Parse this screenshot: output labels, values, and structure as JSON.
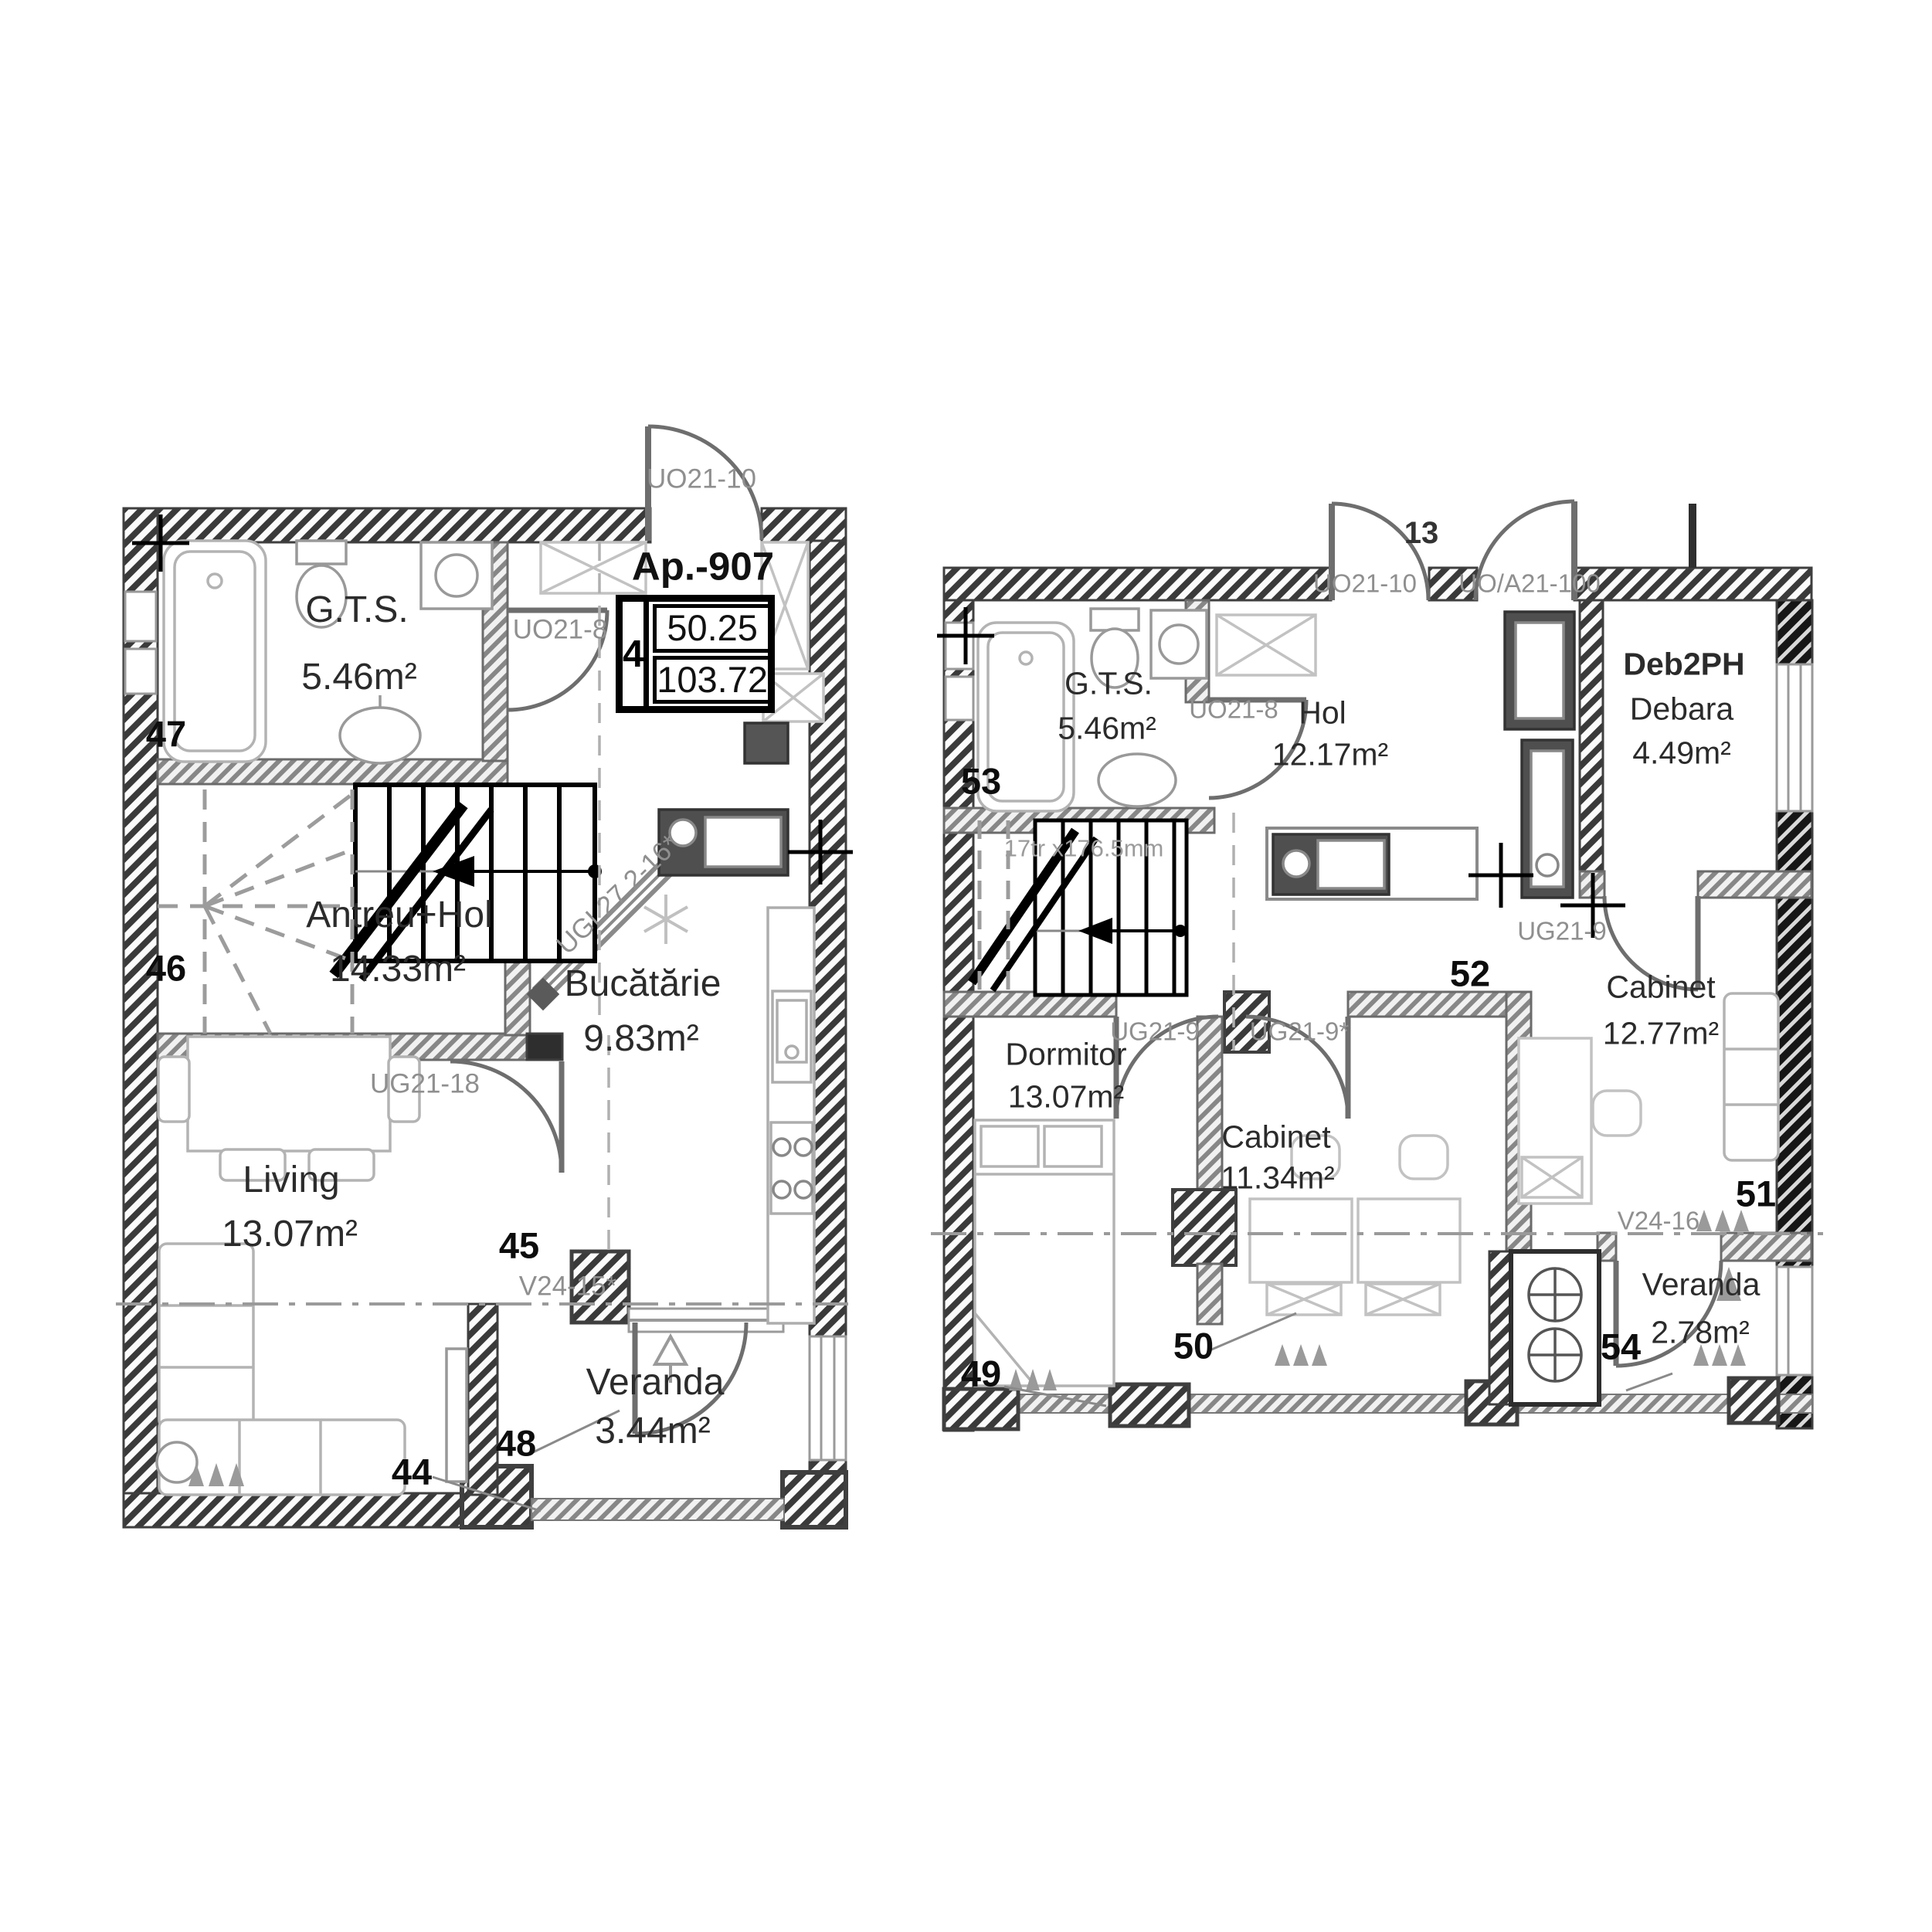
{
  "apartment": {
    "title": "Ap.-907",
    "rooms_count": "4",
    "area_useful": "50.25",
    "area_total": "103.72"
  },
  "colors": {
    "wall_hatch": "#3a3a3a",
    "interior_wall": "#8b8b8b",
    "door_label": "#8f8f8f",
    "room_text": "#2b2b2b",
    "marker_text": "#0d0d0d"
  },
  "plan_lower": {
    "rooms": {
      "gts": {
        "name": "G.T.S.",
        "area": "5.46m²"
      },
      "antreu": {
        "name": "Antreu+Hol",
        "area": "14.33m²"
      },
      "bucatarie": {
        "name": "Bucătărie",
        "area": "9.83m²"
      },
      "living": {
        "name": "Living",
        "area": "13.07m²"
      },
      "veranda": {
        "name": "Veranda",
        "area": "3.44m²"
      }
    },
    "doors": {
      "entry": "UO21-10",
      "bath": "UO21-8",
      "kitchen_window": "UGL27.2-16*",
      "living_door": "UG21-18",
      "veranda_window": "V24-15*"
    },
    "markers": {
      "m44": "44",
      "m45": "45",
      "m46": "46",
      "m47": "47",
      "m48": "48"
    }
  },
  "plan_upper": {
    "rooms": {
      "gts": {
        "name": "G.T.S.",
        "area": "5.46m²"
      },
      "hol": {
        "name": "Hol",
        "area": "12.17m²"
      },
      "debara": {
        "code": "Deb2PH",
        "name": "Debara",
        "area": "4.49m²"
      },
      "dormitor": {
        "name": "Dormitor",
        "area": "13.07m²"
      },
      "cabinet1": {
        "name": "Cabinet",
        "area": "11.34m²"
      },
      "cabinet2": {
        "name": "Cabinet",
        "area": "12.77m²"
      },
      "veranda": {
        "name": "Veranda",
        "area": "2.78m²"
      }
    },
    "doors": {
      "entry_left_no": "13",
      "entry_left": "UO21-10",
      "entry_right": "UO/A21-100",
      "bath": "UO21-8",
      "cab2_door": "UG21-9",
      "dorm_door": "UG21-9",
      "cab1_door": "UG21-9*",
      "veranda_window": "V24-16"
    },
    "stairs_label": "17tr x176.5mm",
    "markers": {
      "m49": "49",
      "m50": "50",
      "m51": "51",
      "m52": "52",
      "m53": "53",
      "m54": "54"
    }
  }
}
